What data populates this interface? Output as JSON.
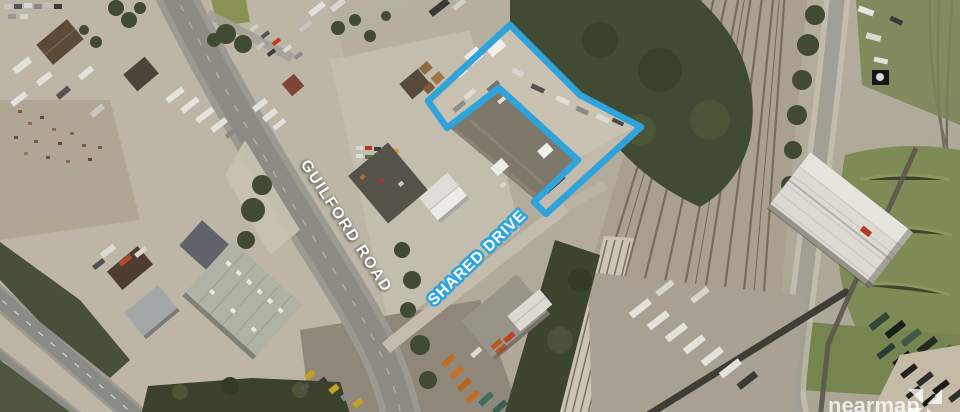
{
  "annotations": {
    "road_label_primary": "GUILFORD ROAD",
    "road_label_secondary": "SHARED DRIVE"
  },
  "parcel": {
    "outline_color": "#2FA3DC",
    "outline_points": "510,25 580,95 641,127 546,214 534,202 578,160 499,88 447,128 428,101"
  },
  "watermark": {
    "brand": "nearmap"
  }
}
